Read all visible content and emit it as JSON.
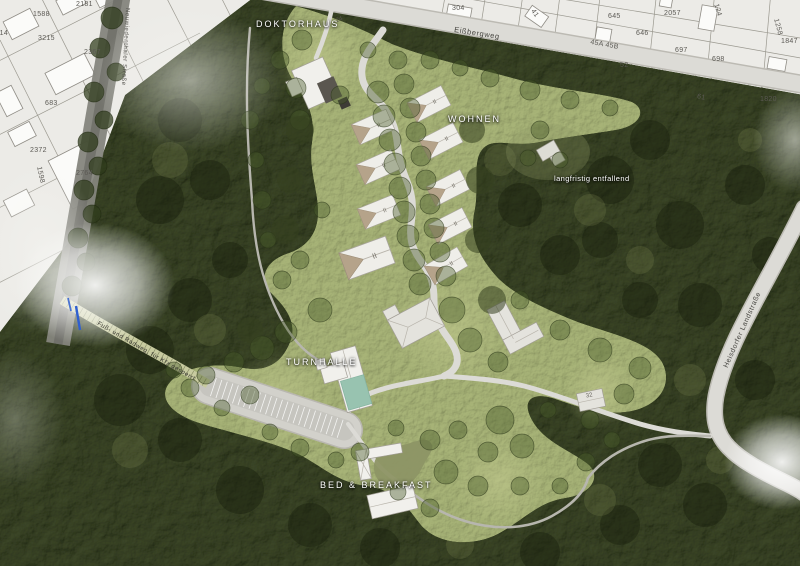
{
  "map": {
    "site_labels": {
      "doktorhaus": "DOKTORHAUS",
      "wohnen": "WOHNEN",
      "turnhalle": "TURNHALLE",
      "bed_breakfast": "BED & BREAKFAST",
      "langfristig_entfallend": "langfristig entfallend"
    },
    "streets": {
      "eissbergweg": "Eißbergweg",
      "landstrasse": "Heisdorfer Landstraße",
      "neuwiedenthaler": "Neuwiedenthaler Straße",
      "fussweg": "Fuß- und Radweg, für Kfz gesperrt"
    },
    "house_numbers": {
      "doktorhaus": "24",
      "nebengebaeude": "32"
    },
    "wohnen_mark": "II",
    "parcels": [
      "2181",
      "1588",
      "114",
      "3215",
      "2367",
      "683",
      "2372",
      "2764",
      "1598",
      "304",
      "41",
      "645",
      "646",
      "45A 45B",
      "52",
      "2057",
      "697",
      "698",
      "61",
      "124",
      "1258",
      "1847",
      "1820"
    ],
    "colors": {
      "forest": "#3c4727",
      "meadow": "#a7b377",
      "road": "#dcdbd6",
      "cadastral": "#ecebe7",
      "building": "#f1f0ec",
      "roof_tan": "#b5a38a",
      "hall_teal": "#98c3b0",
      "pond_green": "#8d9565",
      "label_white": "#ffffff",
      "marker_blue": "#2f5fd0"
    }
  }
}
